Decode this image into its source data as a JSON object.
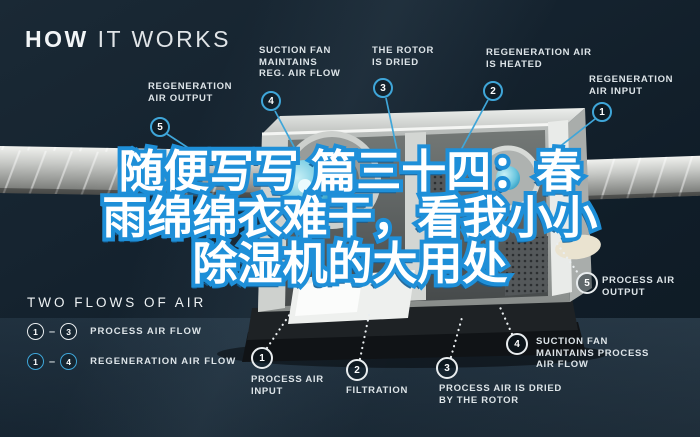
{
  "header": {
    "title_strong": "HOW",
    "title_rest": " IT WORKS"
  },
  "overlay_title": {
    "line1": "随便写写 篇三十四：春",
    "line2": "雨绵绵衣难干，看我小小",
    "line3": "除湿机的大用处"
  },
  "regeneration_callouts": [
    {
      "number": "5",
      "label": "REGENERATION\nAIR OUTPUT"
    },
    {
      "number": "4",
      "label": "SUCTION FAN\nMAINTAINS\nREG. AIR FLOW"
    },
    {
      "number": "3",
      "label": "THE ROTOR\nIS DRIED"
    },
    {
      "number": "2",
      "label": "REGENERATION AIR\nIS HEATED"
    },
    {
      "number": "1",
      "label": "REGENERATION\nAIR INPUT"
    }
  ],
  "process_callouts": [
    {
      "number": "1",
      "label": "PROCESS AIR\nINPUT"
    },
    {
      "number": "2",
      "label": "FILTRATION"
    },
    {
      "number": "3",
      "label": "PROCESS AIR IS DRIED\nBY THE ROTOR"
    },
    {
      "number": "4",
      "label": "SUCTION FAN\nMAINTAINS PROCESS\nAIR FLOW"
    },
    {
      "number": "5",
      "label": "PROCESS AIR\nOUTPUT"
    }
  ],
  "legend": {
    "title": "TWO FLOWS OF AIR",
    "rows": [
      {
        "from": "1",
        "dash": "–",
        "to": "3",
        "label": "PROCESS AIR FLOW"
      },
      {
        "from": "1",
        "dash": "–",
        "to": "4",
        "label": "REGENERATION AIR FLOW"
      }
    ]
  },
  "colors": {
    "background": "#13202b",
    "accent_blue": "#3fa6d9",
    "title_fill": "#ffffff",
    "title_outline": "#1e8fd8",
    "label_text": "#dde4e8"
  }
}
